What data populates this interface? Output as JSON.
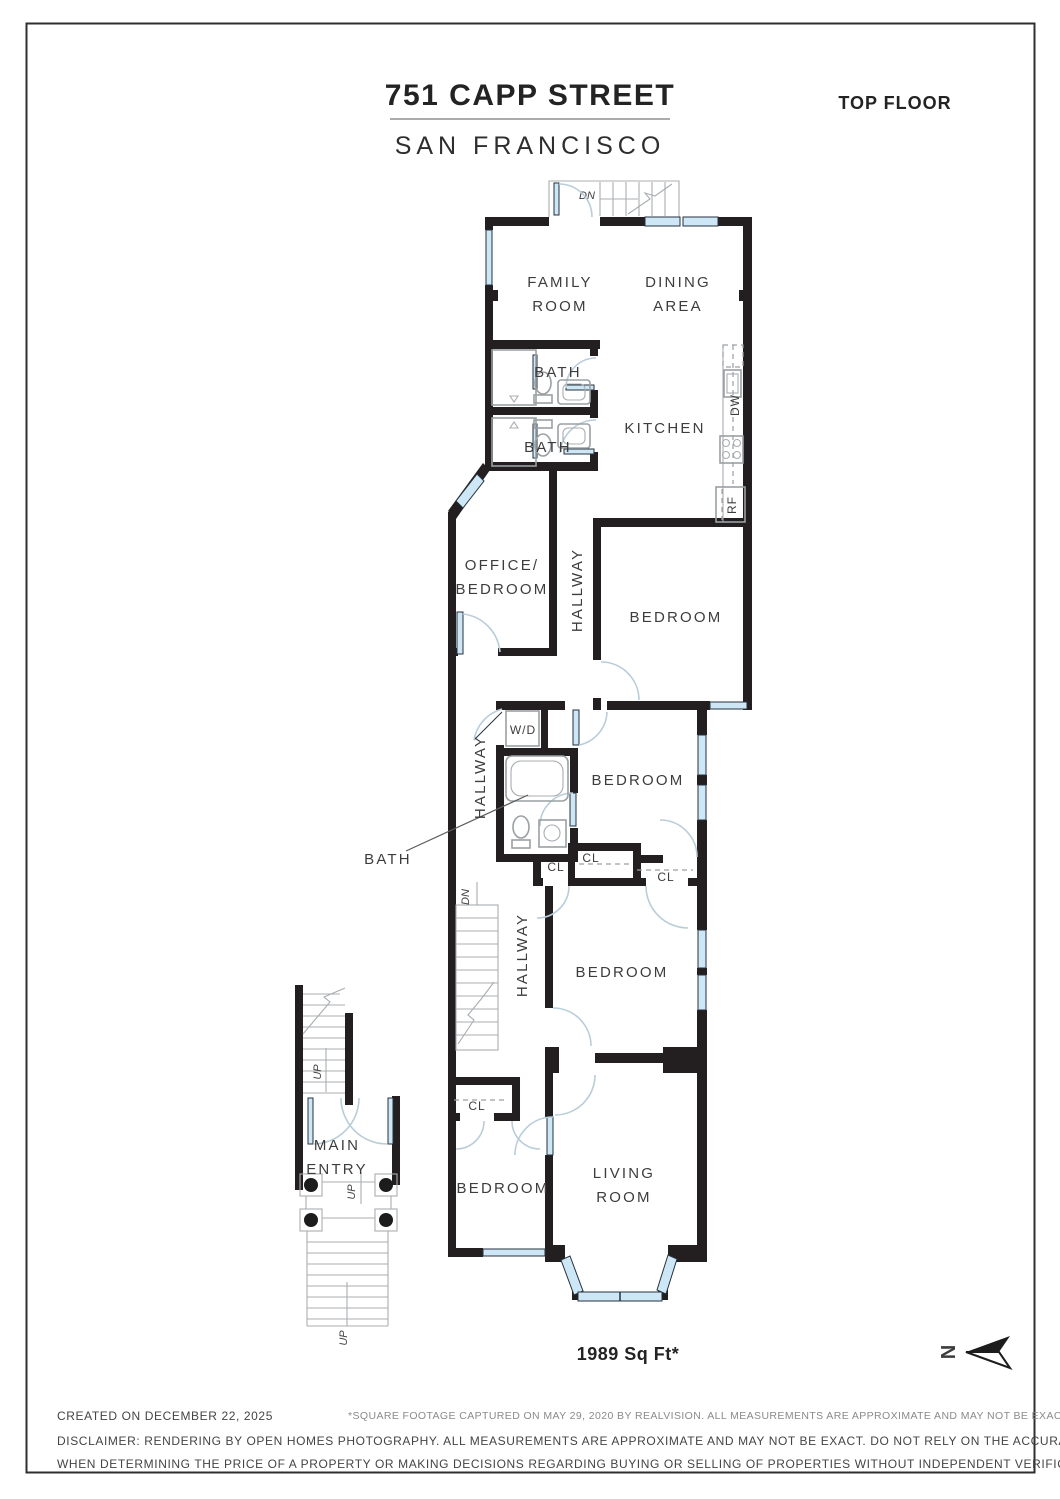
{
  "header": {
    "address": "751 CAPP STREET",
    "city": "SAN FRANCISCO",
    "floor_label": "TOP FLOOR"
  },
  "area_label": "1989 Sq Ft*",
  "north_letter": "N",
  "rooms": {
    "family_1": "FAMILY",
    "family_2": "ROOM",
    "dining_1": "DINING",
    "dining_2": "AREA",
    "bath_top": "BATH",
    "bath_mid": "BATH",
    "bath_callout": "BATH",
    "kitchen": "KITCHEN",
    "office_1": "OFFICE/",
    "office_2": "BEDROOM",
    "hallway_upper": "HALLWAY",
    "hallway_mid": "HALLWAY",
    "hallway_lower": "HALLWAY",
    "bedroom_top": "BEDROOM",
    "bedroom_middle": "BEDROOM",
    "bedroom_lower": "BEDROOM",
    "bedroom_bottom": "BEDROOM",
    "living_1": "LIVING",
    "living_2": "ROOM",
    "main_entry_1": "MAIN",
    "main_entry_2": "ENTRY",
    "wd": "W/D",
    "dw": "DW",
    "rf": "RF",
    "cl_a": "CL",
    "cl_b": "CL",
    "cl_c": "CL",
    "cl_d": "CL",
    "dn_top": "DN",
    "dn_stairs": "DN",
    "up_inner": "UP",
    "up_porch": "UP",
    "up_outer": "UP"
  },
  "footer": {
    "created": "CREATED ON DECEMBER 22, 2025",
    "sqft_note": "*SQUARE FOOTAGE CAPTURED ON MAY 29, 2020 BY REALVISION. ALL MEASUREMENTS ARE APPROXIMATE AND MAY NOT BE EXACT.",
    "disclaimer_1": "DISCLAIMER: RENDERING BY OPEN HOMES PHOTOGRAPHY. ALL MEASUREMENTS ARE APPROXIMATE AND MAY NOT BE EXACT. DO NOT RELY ON THE ACCURACY OF THIS FLOOR PLAN",
    "disclaimer_2": "WHEN DETERMINING THE PRICE OF A PROPERTY OR MAKING DECISIONS REGARDING BUYING OR SELLING OF PROPERTIES WITHOUT INDEPENDENT VERIFICATION."
  },
  "colors": {
    "wall": "#231f20",
    "window_fill": "#cde7f7",
    "door_arc": "#b9cdd9",
    "fixture": "#9aa0a3",
    "text": "#3d3d3d"
  }
}
